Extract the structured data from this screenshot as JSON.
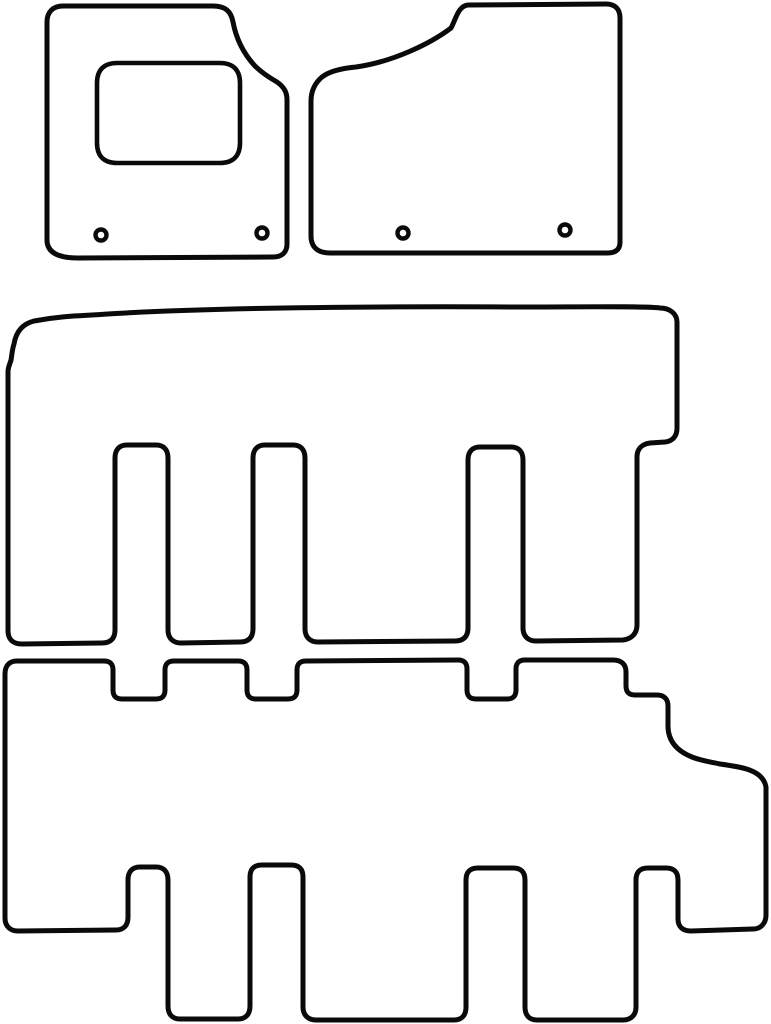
{
  "page": {
    "title": "Tailored car floor mat set cutting template",
    "background_color": "#ffffff"
  },
  "diagram": {
    "canvas": {
      "width": 771,
      "height": 1024
    },
    "stroke_color": "#0a0a0a",
    "outline_stroke_width": 5,
    "detail_stroke_width": 4.6,
    "shape_fill": "#ffffff",
    "grommet": {
      "radius": 5.5,
      "ring_stroke_width": 4.4
    },
    "shapes": [
      {
        "name": "front-driver-mat-outline",
        "kind": "path",
        "role": "mat-outline",
        "d": "M 63 6 L 213 6 C 225 6 231 11 233 22 C 236 38 243 53 255 66 C 262 73 270 78 277 82 C 284 87 287 92 287 100 L 287 244 C 287 252 282 257 273 257 L 78 258 C 66 258 47 256 47 240 L 47 22 C 47 12 53 6 63 6 Z"
      },
      {
        "name": "front-driver-mat-heel-pad",
        "kind": "path",
        "role": "mat-detail",
        "d": "M 117 63 L 220 63 C 233 63 240 70 240 83 L 240 143 C 240 156 233 163 220 163 L 117 163 C 104 163 97 156 97 143 L 97 83 C 97 70 104 63 117 63 Z"
      },
      {
        "name": "front-passenger-mat-outline",
        "kind": "path",
        "role": "mat-outline",
        "d": "M 468 5 L 606 4 C 615 4 620 9 620 18 L 620 242 C 620 250 615 253 607 253 L 330 253 C 319 253 311 248 311 236 L 311 101 C 311 91 315 83 322 77 C 331 70 345 68 356 67 C 392 62 430 44 451 28 C 456 19 458 6 468 5 Z"
      },
      {
        "name": "middle-row-mat-outline",
        "kind": "path",
        "role": "mat-outline",
        "d": "M 8 372 C 8 367 10 364 11 360 C 12 355 12 350 14 344 C 16 332 22 324 34 321 C 55 317 72 316 92 315 C 180 309 320 306 520 307 C 580 307 645 306 660 308 C 670 308 677 314 677 322 L 677 428 C 677 436 673 441 665 442 L 650 443 C 642 444 637 449 637 457 L 637 625 C 637 633 632 639 623 640 L 536 641 C 528 641 523 636 523 628 L 523 460 C 523 452 519 447 511 447 L 480 447 C 472 447 468 452 468 460 L 468 628 C 468 636 464 641 455 641 L 318 642 C 310 642 305 637 305 629 L 305 458 C 305 450 301 445 293 445 L 265 445 C 257 445 253 450 253 458 L 253 629 C 253 637 249 642 240 642 L 181 643 C 173 643 168 638 168 630 L 168 458 C 168 450 164 445 156 445 L 127 445 C 119 445 115 450 115 458 L 115 630 C 115 638 111 643 102 643 L 22 644 C 13 644 8 639 8 631 Z"
      },
      {
        "name": "rear-row-mat-outline",
        "kind": "path",
        "role": "mat-outline",
        "d": "M 5 918 L 5 674 C 5 666 9 661 17 661 L 104 661 C 110 661 113 664 113 670 L 113 690 C 113 696 116 699 122 699 L 156 699 C 162 699 165 696 165 690 L 165 670 C 165 664 168 661 174 661 L 238 661 C 244 661 247 664 247 670 L 247 690 C 247 696 250 699 256 699 L 288 699 C 294 699 297 696 297 690 L 297 670 C 297 664 300 661 306 661 L 458 660 C 464 660 467 663 467 669 L 467 690 C 467 696 470 699 476 699 L 507 699 C 513 699 516 696 516 690 L 516 669 C 516 663 519 660 525 660 L 613 660 C 621 660 626 664 626 672 L 626 686 C 626 692 629 695 635 695 L 657 695 C 664 695 668 699 668 706 L 668 726 C 668 741 677 751 692 757 C 702 761 711 762 720 764 C 742 767 763 770 766 787 L 766 915 C 766 923 761 929 753 929 L 691 931 C 683 931 678 927 678 919 L 678 880 C 678 872 674 868 666 868 L 648 868 C 640 868 636 872 636 880 L 636 1007 C 636 1015 631 1020 623 1020 L 537 1020 C 529 1020 525 1015 525 1007 L 525 880 C 525 872 521 868 513 868 L 478 868 C 470 868 466 872 466 880 L 466 1007 C 466 1015 462 1020 454 1020 L 316 1020 C 308 1020 303 1015 303 1007 L 303 877 C 303 869 299 865 291 865 L 262 865 C 254 865 250 869 250 877 L 250 1006 C 250 1014 246 1019 238 1019 L 180 1019 C 172 1019 168 1014 168 1006 L 168 880 C 168 872 164 867 156 867 L 140 867 C 132 867 128 872 128 880 L 128 917 C 128 925 124 930 116 930 L 18 931 C 10 931 5 926 5 918 Z"
      },
      {
        "name": "front-driver-mat-grommet-left",
        "kind": "grommet",
        "cx": 101,
        "cy": 235
      },
      {
        "name": "front-driver-mat-grommet-right",
        "kind": "grommet",
        "cx": 262,
        "cy": 233
      },
      {
        "name": "front-passenger-mat-grommet-left",
        "kind": "grommet",
        "cx": 403,
        "cy": 233
      },
      {
        "name": "front-passenger-mat-grommet-right",
        "kind": "grommet",
        "cx": 565,
        "cy": 230
      }
    ]
  }
}
